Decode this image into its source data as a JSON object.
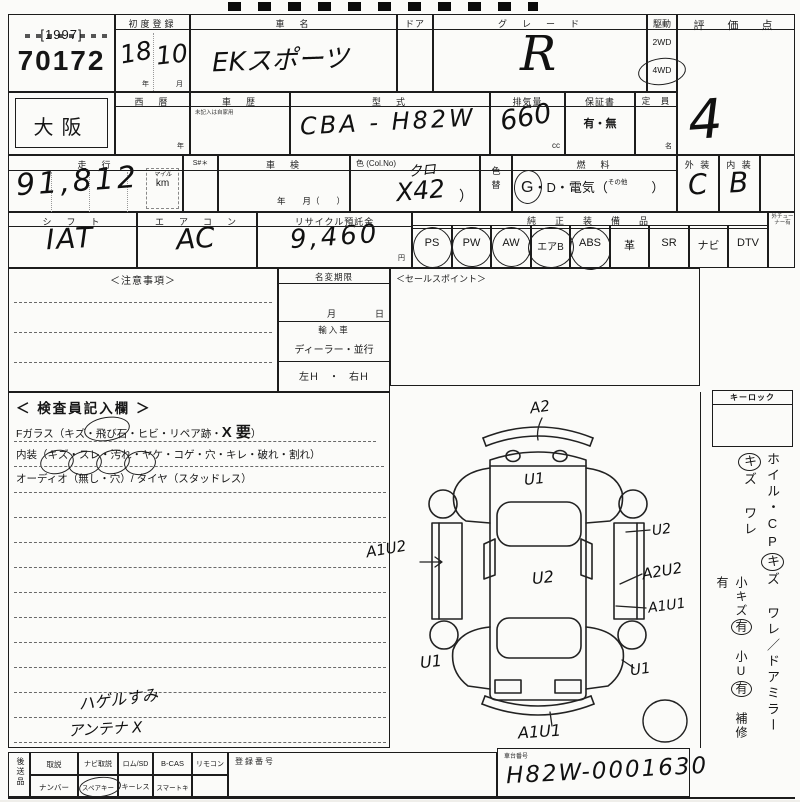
{
  "lot": {
    "bracket_year": "[1997]",
    "number": "70172"
  },
  "r1": {
    "first_reg_label": "初度登録",
    "first_reg_year": "18",
    "first_reg_month": "10",
    "year_unit": "年",
    "month_unit": "月",
    "car_name_label": "車　名",
    "car_name_value": "EKスポーツ",
    "door_label": "ドア",
    "grade_label": "グ　レ　ー　ド",
    "grade_value": "R",
    "drive_label": "駆動",
    "drive_2wd": "2WD",
    "drive_4wd": "4WD",
    "score_label": "評　価　点",
    "score_value": "4"
  },
  "r2": {
    "prefecture": "大阪",
    "calendar_label": "西　暦",
    "calendar_unit": "年",
    "history_label": "車　歴",
    "history_note": "未記入は自家用",
    "model_label": "型　式",
    "model_value": "CBA - H82W",
    "disp_label": "排気量",
    "disp_value": "660",
    "disp_unit": "cc",
    "warranty_label": "保証書",
    "warranty_value": "有・無",
    "capacity_label": "定　員",
    "capacity_unit": "名"
  },
  "r3": {
    "mileage_label": "走　行",
    "mileage_value": "91,812",
    "mile_unit": "マイル",
    "km_unit": "km",
    "s_label": "S#＊",
    "shaken_label": "車　検",
    "shaken_units": "年　　月（　　）",
    "color_label": "色 (Col.No)",
    "color_name": "クロ",
    "color_code": "X42",
    "color_paren": "）",
    "colorchg_1": "色",
    "colorchg_2": "替",
    "fuel_label": "燃　料",
    "fuel_g": "G",
    "fuel_mid": "・D・電気（",
    "fuel_other": "その他",
    "fuel_close": "）",
    "ext_label": "外 装",
    "ext_value": "C",
    "int_label": "内 装",
    "int_value": "B"
  },
  "r4": {
    "shift_label": "シ　フ　ト",
    "shift_value": "IAT",
    "ac_label": "エ　ア　コ　ン",
    "ac_value": "AC",
    "recycle_label": "リサイクル預託金",
    "recycle_value": "9,460",
    "recycle_unit": "円",
    "equip_label": "純　正　装　備　品",
    "equip": [
      {
        "label": "PS"
      },
      {
        "label": "PW"
      },
      {
        "label": "AW"
      },
      {
        "label": "エアB"
      },
      {
        "label": "ABS"
      },
      {
        "label": "革"
      },
      {
        "label": "SR"
      },
      {
        "label": "ナビ"
      },
      {
        "label": "DTV"
      }
    ],
    "tuner_note": "外チューナー有"
  },
  "mid": {
    "notes_label": "＜注意事項＞",
    "namechange_label": "名変期限",
    "month_unit": "月",
    "day_unit": "日",
    "import_label": "輸入車",
    "import_type": "ディーラー・並行",
    "steering": "左Ｈ　・　右Ｈ",
    "sales_label": "＜セールスポイント＞"
  },
  "inspector": {
    "title": "＜ 検査員記入欄 ＞",
    "fg": [
      {
        "t": "Fガラス（キズ・"
      },
      {
        "t": "飛び石"
      },
      {
        "t": "・ヒビ・リペア跡・"
      },
      {
        "t": "X 要"
      },
      {
        "t": "）"
      }
    ],
    "il": [
      {
        "t": "内装（"
      },
      {
        "t": "キズ"
      },
      {
        "t": "・"
      },
      {
        "t": "スレ"
      },
      {
        "t": "・"
      },
      {
        "t": "汚れ"
      },
      {
        "t": "・"
      },
      {
        "t": "ヤケ"
      },
      {
        "t": "・コゲ・穴・キレ・破れ・割れ）"
      }
    ],
    "audio": "オーディオ（無し・穴）/ タイヤ（スタッドレス）",
    "note1": "ハゲルすみ",
    "note2": "アンテナ X"
  },
  "diagram": {
    "a": [
      {
        "t": "A2"
      },
      {
        "t": "U1"
      },
      {
        "t": "U2"
      },
      {
        "t": "A1U2"
      },
      {
        "t": "A2U2"
      },
      {
        "t": "U2"
      },
      {
        "t": "A1U1"
      },
      {
        "t": "U1"
      },
      {
        "t": "U1"
      },
      {
        "t": "A1U1"
      }
    ]
  },
  "sidebar": {
    "keylock": "キーロック",
    "colA": [
      {
        "t": "ホイル・CP"
      },
      {
        "t": "キ"
      },
      {
        "t": "ズ ワレ／ドアミラー"
      },
      {
        "t": "キ"
      },
      {
        "t": "ズ ワレ"
      }
    ],
    "colB": [
      {
        "t": "小キズ"
      },
      {
        "t": "有"
      },
      {
        "t": "　小U"
      },
      {
        "t": "有"
      },
      {
        "t": "　補修有"
      }
    ]
  },
  "bottom": {
    "later_items": "後送品",
    "r1": [
      {
        "label": "取説"
      },
      {
        "label": "ナビ取説"
      },
      {
        "label": "ロム/SD"
      },
      {
        "label": "B-CAS"
      },
      {
        "label": "リモコン"
      }
    ],
    "r2": [
      {
        "label": "ナンバー"
      },
      {
        "label": "スペアキー"
      },
      {
        "label": "キーレス"
      },
      {
        "label": "スマートキー"
      }
    ],
    "reg_label": "登録番号",
    "chassis_label": "車台番号",
    "chassis_value": "H82W-0001630"
  }
}
